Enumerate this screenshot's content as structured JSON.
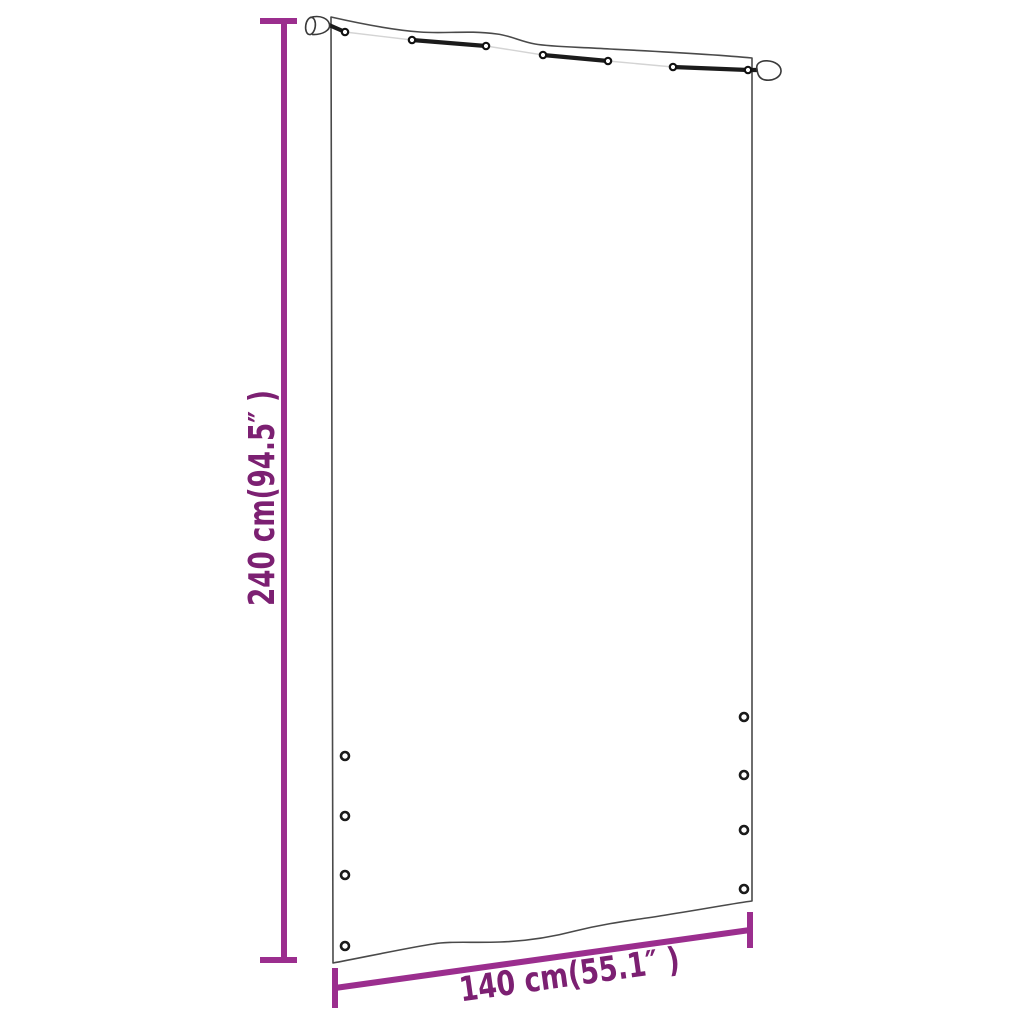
{
  "dimensions": {
    "height": {
      "label": "240 cm(94.5″ )",
      "cm": 240,
      "inches": 94.5
    },
    "width": {
      "label": "140 cm(55.1″ )",
      "cm": 140,
      "inches": 55.1
    }
  },
  "figure": {
    "subject": "curtain-panel-with-hanging-cord",
    "grommets_left": 4,
    "grommets_right": 4,
    "cord_rings": 7,
    "rod_end_caps": 2
  },
  "colors": {
    "dimension_line": "#9B2E8E",
    "dimension_text": "#7C2072",
    "panel_outline": "#4A4A4A",
    "cord": "#1B1B1B",
    "background": "#FFFFFF"
  }
}
